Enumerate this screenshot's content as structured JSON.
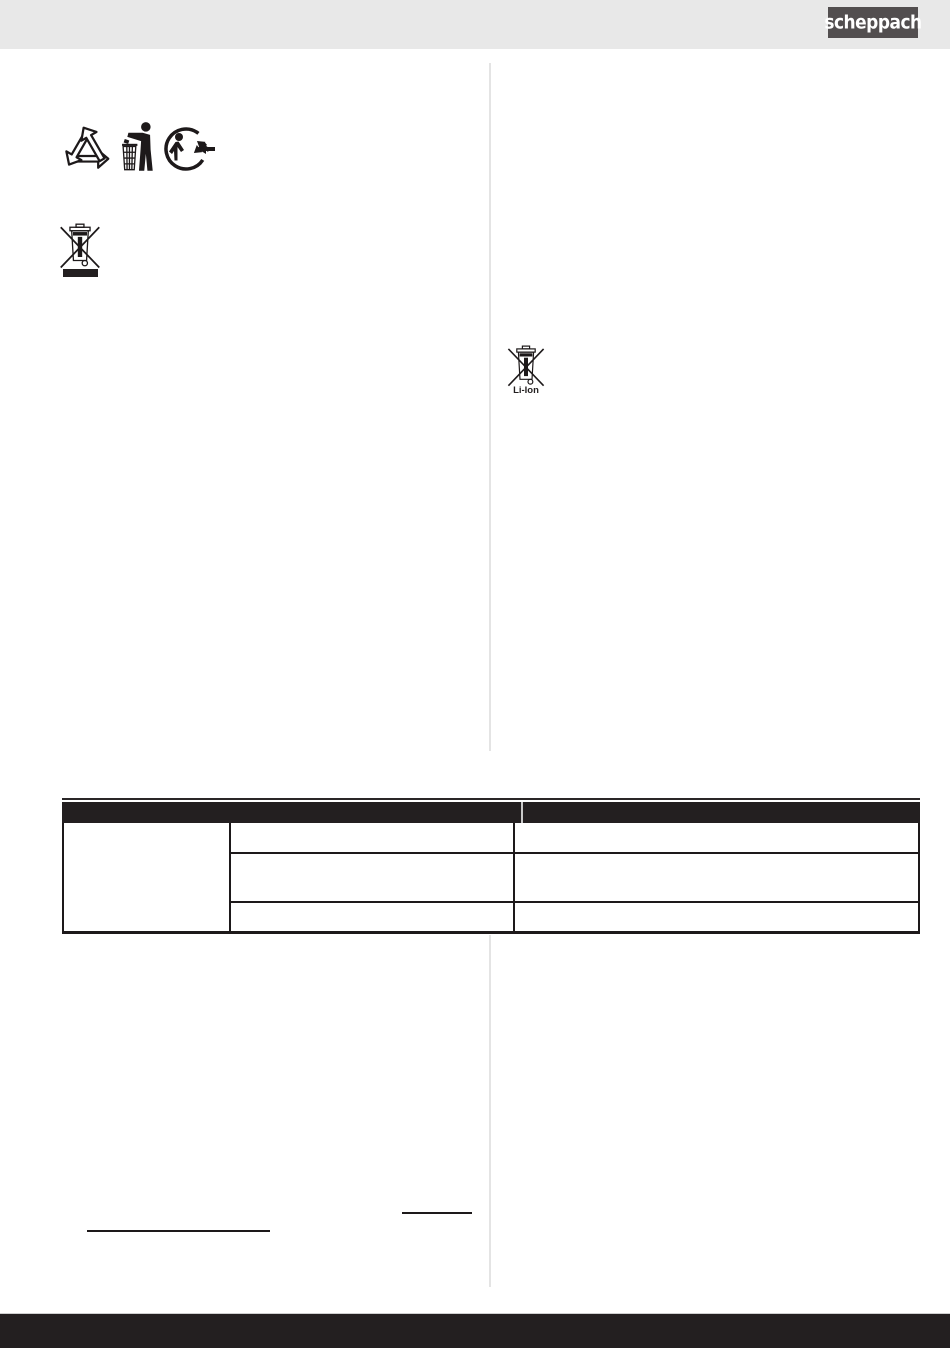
{
  "brand": {
    "logo_text": "scheppach"
  },
  "symbols": {
    "recycling_loop_icon": "recycling-moebius-loop",
    "tidy_man_icon": "dispose-in-bin-figure",
    "triman_icon": "triman-circular-recycling",
    "weee_icon": "crossed-out-wheeled-bin-with-bar",
    "battery_icon": "crossed-out-wheeled-bin",
    "battery_label": "Li-Ion"
  },
  "table": {
    "header_cells": {
      "left": "",
      "right": ""
    },
    "rows": [
      {
        "col1": "",
        "col2": "",
        "col3": ""
      },
      {
        "col2": "",
        "col3": ""
      },
      {
        "col2": "",
        "col3": ""
      }
    ]
  },
  "links": {
    "left_underlined_text": "",
    "right_underlined_text": ""
  },
  "colors": {
    "topbar_bg": "#e8e8e8",
    "logo_bg": "#524e4f",
    "ink": "#231f20",
    "column_divider": "#e4e4e4",
    "table_header_bg": "#231f20",
    "table_header_separator": "#c9c9c9",
    "footer_bg": "#231f20"
  }
}
